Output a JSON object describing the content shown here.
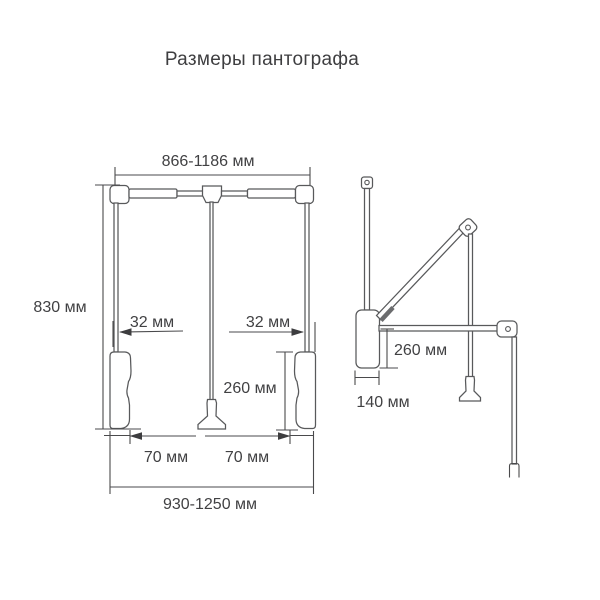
{
  "title": "Размеры пантографа",
  "front_view": {
    "top_width": "866-1186 мм",
    "height": "830 мм",
    "left_tube_offset": "32 мм",
    "right_tube_offset": "32 мм",
    "grip_length": "260 мм",
    "left_grip_offset": "70 мм",
    "right_grip_offset": "70 мм",
    "bottom_width": "930-1250 мм"
  },
  "side_view": {
    "arm_drop": "260 мм",
    "body_depth": "140 мм"
  },
  "colors": {
    "background": "#ffffff",
    "line": "#58595b",
    "text": "#414143"
  }
}
